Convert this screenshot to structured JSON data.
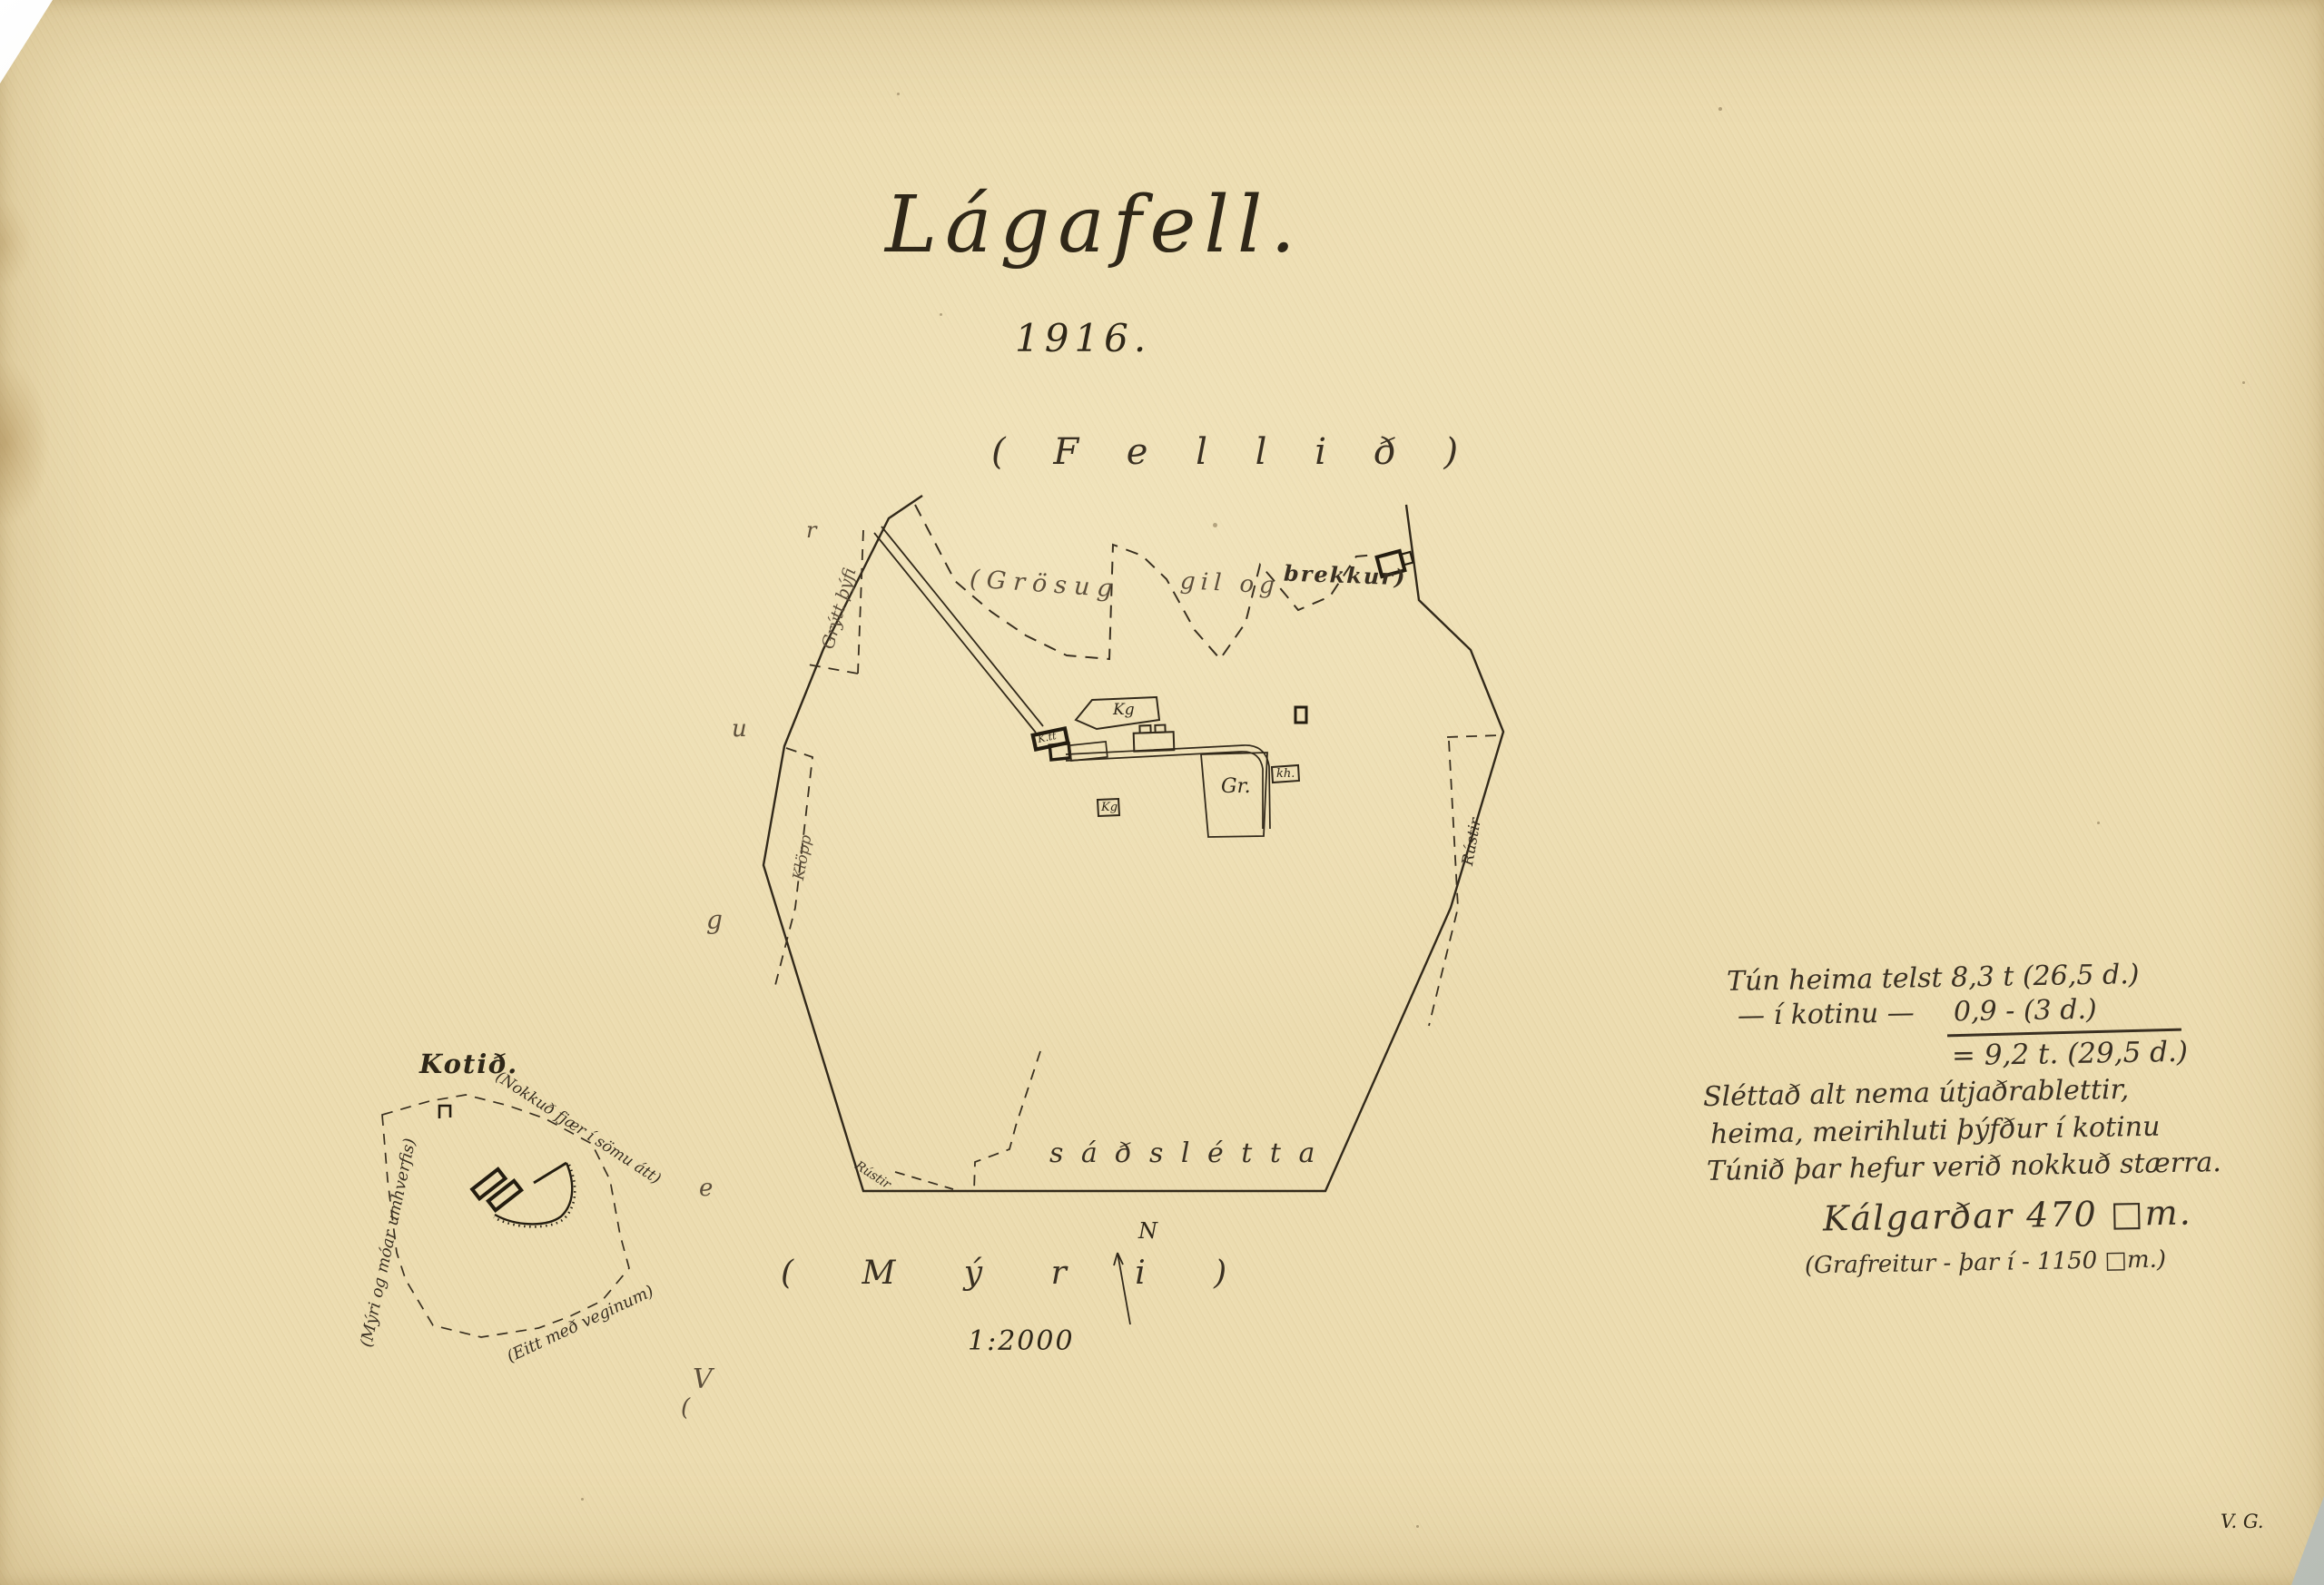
{
  "header": {
    "title": "Lágafell.",
    "year": "1916."
  },
  "map": {
    "fell_label": "( F e l l i ð )",
    "myri_label": "( M ý r i )",
    "sadsletta_label": "s á ð s l é t t a",
    "grosug": "(Grösug",
    "gil_og": "gil og",
    "brekkur": "brekkur)",
    "grytt_thyfi": "Grýtt þýfi",
    "klopp": "Klöpp",
    "rustir_right": "Rústir",
    "rustir_bottom": "Rústir",
    "vegur_letters": [
      "(",
      "V",
      "e",
      "g",
      "u",
      "r"
    ],
    "north": "N",
    "scale": "1:2000",
    "buildings": {
      "farmhouse": "K.tt",
      "kalgardur_a": "Kg",
      "kalgardur_b": "Kg",
      "cemetery": "Gr.",
      "kh": "kh."
    }
  },
  "kotid": {
    "title": "Kotið.",
    "near_note": "(Nokkuð fjær í sömu átt)",
    "left_note": "(Mýri og móar umhverfis)",
    "road_note": "(Eitt með veginum)"
  },
  "notes": {
    "l1": "Tún heima telst 8,3 t (26,5 d.)",
    "l2a": "— í kotinu —",
    "l2b": "0,9 - (3 d.)",
    "l3": "= 9,2 t. (29,5 d.)",
    "l4": "Sléttað alt nema útjaðrablettir,",
    "l5": "heima, meirihluti þýfður í kotinu",
    "l6": "Túnið þar hefur verið nokkuð stærra.",
    "l7": "Kálgarðar 470 □m.",
    "l8": "(Grafreitur - þar í - 1150 □m.)"
  },
  "signature": "V. G.",
  "colors": {
    "paper": "#ecdcb0",
    "ink": "#2f2718",
    "pencil": "#5d4f3b"
  }
}
